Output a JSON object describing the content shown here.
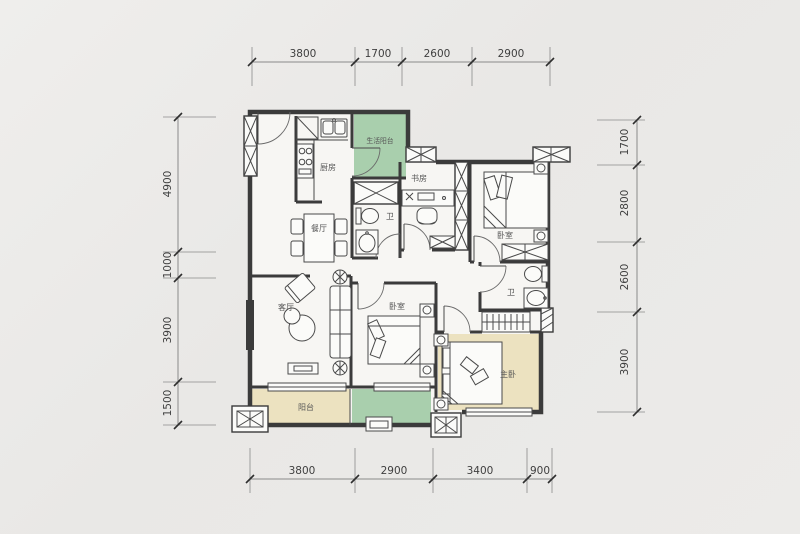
{
  "background": {
    "color": "#e9e8e6"
  },
  "plan": {
    "type": "apartment-floor-plan",
    "wall_color": "#3b3b3b",
    "accent_green": "#a9cfad",
    "accent_beige": "#ece2c0",
    "rooms": {
      "kitchen": "厨房",
      "life_balcony": "生活阳台",
      "study": "书房",
      "bath_main": "卫",
      "dining": "餐厅",
      "bedroom_ne": "卧室",
      "living": "客厅",
      "bedroom_mid": "卧室",
      "bath_second": "卫",
      "master": "主卧",
      "balcony": "阳台"
    },
    "dims": {
      "top": [
        "3800",
        "1700",
        "2600",
        "2900"
      ],
      "bottom": [
        "3800",
        "2900",
        "3400",
        "900"
      ],
      "left": [
        "4900",
        "1000",
        "3900",
        "1500"
      ],
      "right": [
        "1700",
        "2800",
        "2600",
        "3900"
      ]
    }
  }
}
